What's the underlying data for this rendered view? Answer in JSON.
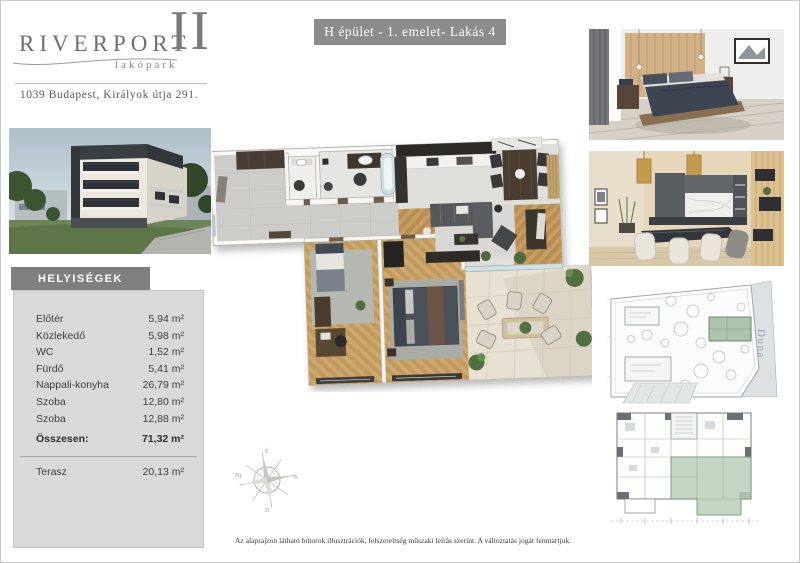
{
  "logo": {
    "name": "RIVERPORT",
    "numeral": "II",
    "subtitle": "lakópark",
    "address": "1039 Budapest, Királyok útja 291."
  },
  "unit_banner": {
    "label": "H épület - 1. emelet- Lakás 4",
    "background": "#8c8c8c"
  },
  "rooms_panel": {
    "title": "HELYISÉGEK",
    "header_background": "#7f7f7f",
    "panel_background": "#d9d9d9",
    "rows": [
      {
        "label": "Előtér",
        "value": "5,94 m²"
      },
      {
        "label": "Közlekedő",
        "value": "5,98 m²"
      },
      {
        "label": "WC",
        "value": "1,52 m²"
      },
      {
        "label": "Fürdő",
        "value": "5,41 m²"
      },
      {
        "label": "Nappali-konyha",
        "value": "26,79 m²"
      },
      {
        "label": "Szoba",
        "value": "12,80 m²"
      },
      {
        "label": "Szoba",
        "value": "12,88 m²"
      }
    ],
    "total": {
      "label": "Összesen:",
      "value": "71,32 m²"
    },
    "terrace": {
      "label": "Terasz",
      "value": "20,13 m²"
    }
  },
  "media": {
    "building_photo": "building-exterior-render",
    "bedroom_photo": "bedroom-interior-render",
    "dining_photo": "dining-kitchen-interior-render",
    "floor_plan": "apartment-3d-floor-plan",
    "site_plan": "site-plan-drawing",
    "level_plan": "floor-level-plan-drawing"
  },
  "site_plan": {
    "river_label": "Duna",
    "highlight_color": "#abc4ab"
  },
  "level_plan": {
    "highlight_color": "#b9cfb9"
  },
  "footer": {
    "disclaimer": "Az alaprajzon látható bútorok illusztrációk, felszereltség műszaki leírás szerint. A változtatás jogát fenntartjuk."
  }
}
